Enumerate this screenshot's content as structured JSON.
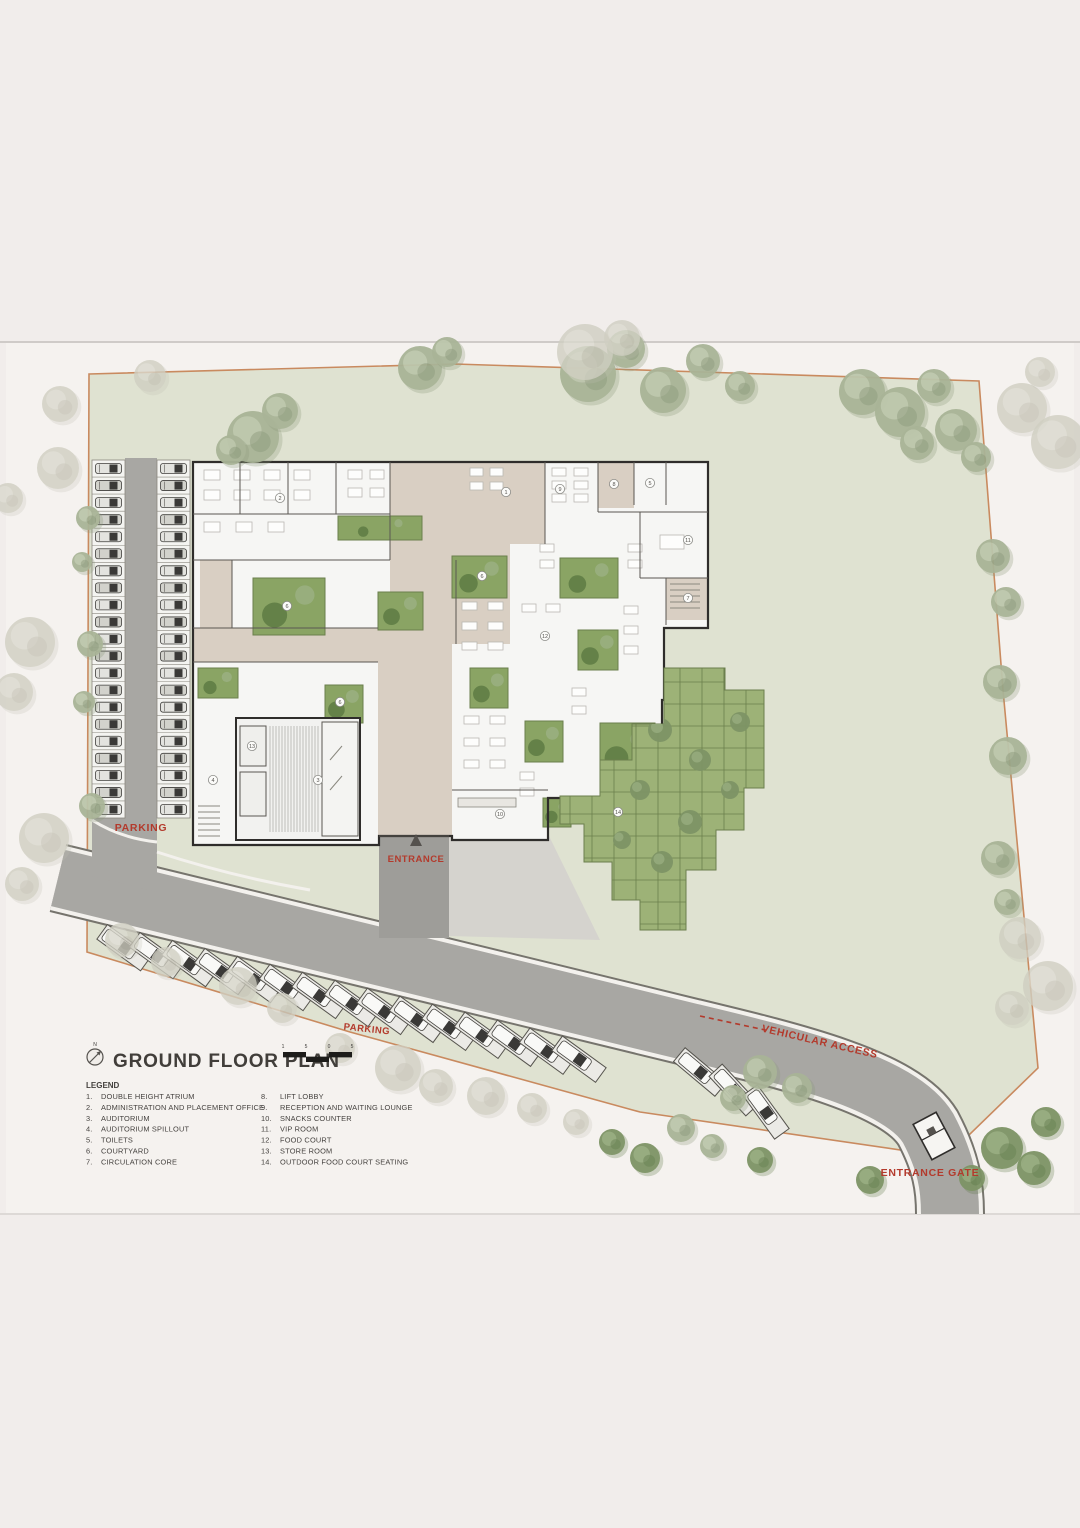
{
  "title_block": {
    "north_label": "N",
    "title": "GROUND FLOOR PLAN",
    "scale_labels": [
      "1",
      "5",
      "0",
      "5"
    ]
  },
  "site_labels": {
    "parking_left": "PARKING",
    "parking_road": "PARKING",
    "entrance": "ENTRANCE",
    "vehicular_access": "VEHICULAR ACCESS",
    "entrance_gate": "ENTRANCE GATE"
  },
  "legend": {
    "heading": "LEGEND",
    "items": [
      {
        "num": "1.",
        "label": "DOUBLE HEIGHT ATRIUM"
      },
      {
        "num": "2.",
        "label": "ADMINISTRATION AND PLACEMENT OFFICE"
      },
      {
        "num": "3.",
        "label": "AUDITORIUM"
      },
      {
        "num": "4.",
        "label": "AUDITORIUM SPILLOUT"
      },
      {
        "num": "5.",
        "label": "TOILETS"
      },
      {
        "num": "6.",
        "label": "COURTYARD"
      },
      {
        "num": "7.",
        "label": "CIRCULATION CORE"
      },
      {
        "num": "8.",
        "label": "LIFT LOBBY"
      },
      {
        "num": "9.",
        "label": "RECEPTION AND WAITING LOUNGE"
      },
      {
        "num": "10.",
        "label": "SNACKS COUNTER"
      },
      {
        "num": "11.",
        "label": "VIP ROOM"
      },
      {
        "num": "12.",
        "label": "FOOD COURT"
      },
      {
        "num": "13.",
        "label": "STORE ROOM"
      },
      {
        "num": "14.",
        "label": "OUTDOOR FOOD COURT SEATING"
      }
    ]
  },
  "plan_markers": [
    {
      "n": "1",
      "x": 506,
      "y": 492
    },
    {
      "n": "2",
      "x": 280,
      "y": 498
    },
    {
      "n": "3",
      "x": 318,
      "y": 780
    },
    {
      "n": "4",
      "x": 213,
      "y": 780
    },
    {
      "n": "5",
      "x": 650,
      "y": 483
    },
    {
      "n": "6",
      "x": 287,
      "y": 606
    },
    {
      "n": "6",
      "x": 482,
      "y": 576
    },
    {
      "n": "6",
      "x": 340,
      "y": 702
    },
    {
      "n": "7",
      "x": 688,
      "y": 598
    },
    {
      "n": "8",
      "x": 614,
      "y": 484
    },
    {
      "n": "9",
      "x": 560,
      "y": 489
    },
    {
      "n": "10",
      "x": 500,
      "y": 814
    },
    {
      "n": "11",
      "x": 688,
      "y": 540
    },
    {
      "n": "12",
      "x": 545,
      "y": 636
    },
    {
      "n": "13",
      "x": 252,
      "y": 746
    },
    {
      "n": "14",
      "x": 618,
      "y": 812
    }
  ],
  "parking": {
    "left_columns": 2,
    "stalls_per_column": 21,
    "roadside_stalls": 18
  },
  "colors": {
    "page_bg": "#f1edeb",
    "sheet": "#f5f2ef",
    "sheet_edge": "#cfcbc8",
    "site_green": "#dfe2d1",
    "boundary": "#c98a5f",
    "road": "#a8a7a3",
    "road_edge_dark": "#76746d",
    "road_curb_white": "#f3f1ed",
    "walkway": "#9e9d99",
    "plaza": "#d5d3ce",
    "building_fill": "#f6f6f4",
    "wall": "#2f2d2b",
    "circulation_beige": "#d9cfc3",
    "courtyard_green": "#8aa464",
    "courtyard_edge": "#6b7f4d",
    "courtyard_tree": "#5f7d45",
    "grid_green": "#9db277",
    "grid_line": "#6b7f4d",
    "tree_sage": "#a9b497",
    "tree_sage_light": "#c3ccb2",
    "tree_sage_dark": "#8a9879",
    "tree_faded": "#d0cfc2",
    "tree_faded_light": "#dedcd1",
    "tree_faded_dark": "#bdbcae",
    "tree_dark": "#7d9465",
    "tree_dark_light": "#9bb083",
    "tree_dark_dark": "#627b4c",
    "label_red": "#b33a2c",
    "text_dark": "#45423f",
    "car_body_a": "#e3e3df",
    "car_body_b": "#d2d2cc",
    "car_cabin": "#3a3937",
    "stall_fill": "#f4f4f1",
    "stall_line": "#8a887f"
  }
}
